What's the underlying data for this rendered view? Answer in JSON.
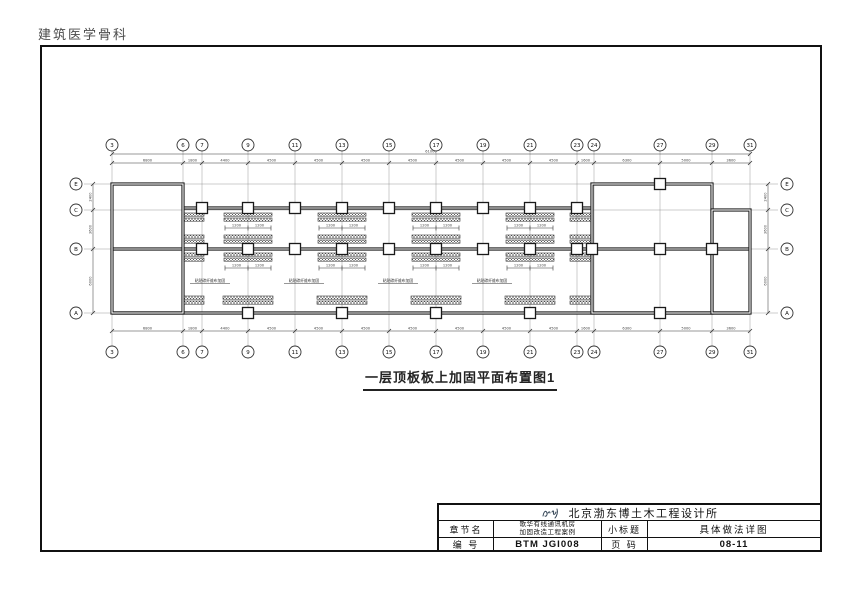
{
  "page": {
    "watermark": "建筑医学骨科"
  },
  "drawing": {
    "title": "一层顶板板上加固平面布置图1",
    "plan": {
      "cols": [
        {
          "label": "3",
          "x": 112
        },
        {
          "label": "6",
          "x": 183
        },
        {
          "label": "7",
          "x": 202
        },
        {
          "label": "9",
          "x": 248
        },
        {
          "label": "11",
          "x": 295
        },
        {
          "label": "13",
          "x": 342
        },
        {
          "label": "15",
          "x": 389
        },
        {
          "label": "17",
          "x": 436
        },
        {
          "label": "19",
          "x": 483
        },
        {
          "label": "21",
          "x": 530
        },
        {
          "label": "23",
          "x": 577
        },
        {
          "label": "24",
          "x": 594
        },
        {
          "label": "27",
          "x": 660
        },
        {
          "label": "29",
          "x": 712
        },
        {
          "label": "31",
          "x": 750
        }
      ],
      "rows": [
        {
          "label": "E",
          "y": 184
        },
        {
          "label": "C",
          "y": 210
        },
        {
          "label": "B",
          "y": 249
        },
        {
          "label": "A",
          "y": 313
        }
      ],
      "dims_x": [
        "6800",
        "1800",
        "4400",
        "4500",
        "4500",
        "4500",
        "4500",
        "4500",
        "4500",
        "4500",
        "1600",
        "6300",
        "5000",
        "3600"
      ],
      "dims_y": [
        "2400",
        "3600",
        "6000"
      ],
      "total_dim": "61000",
      "geom": {
        "top_bubble_y": 145,
        "bottom_bubble_y": 352,
        "left_bubble_x": 76,
        "right_bubble_x": 787,
        "bubble_r": 6,
        "dim_top_y": 163,
        "dim_total_y": 154,
        "dim_bottom_y": 331,
        "dim_left_x": 93,
        "dim_right_x": 768,
        "v_top": 150,
        "v_bot": 346,
        "h_left": 84,
        "h_right": 778
      },
      "rooms": [
        {
          "x": 112,
          "y": 184,
          "w": 71,
          "h": 129
        },
        {
          "x": 592,
          "y": 184,
          "w": 120,
          "h": 129
        },
        {
          "x": 712,
          "y": 210,
          "w": 38,
          "h": 103
        }
      ],
      "beams": [
        {
          "x1": 112,
          "y": 249,
          "x2": 750
        },
        {
          "x1": 112,
          "y": 313,
          "x2": 750
        },
        {
          "x1": 183,
          "y": 208,
          "x2": 592
        }
      ],
      "columns": [
        [
          202,
          208
        ],
        [
          248,
          208
        ],
        [
          295,
          208
        ],
        [
          342,
          208
        ],
        [
          389,
          208
        ],
        [
          436,
          208
        ],
        [
          483,
          208
        ],
        [
          530,
          208
        ],
        [
          577,
          208
        ],
        [
          202,
          249
        ],
        [
          248,
          249
        ],
        [
          295,
          249
        ],
        [
          342,
          249
        ],
        [
          389,
          249
        ],
        [
          436,
          249
        ],
        [
          483,
          249
        ],
        [
          530,
          249
        ],
        [
          577,
          249
        ],
        [
          592,
          249
        ],
        [
          660,
          249
        ],
        [
          712,
          249
        ],
        [
          248,
          313
        ],
        [
          342,
          313
        ],
        [
          436,
          313
        ],
        [
          530,
          313
        ],
        [
          660,
          313
        ],
        [
          660,
          184
        ]
      ],
      "column_size": 11,
      "strip_centers": [
        248,
        342,
        436,
        530
      ],
      "clusters": [
        {
          "dy": [
            213,
            218
          ],
          "half": 24
        },
        {
          "dy": [
            235,
            240
          ],
          "half": 24
        },
        {
          "dy": [
            253,
            258
          ],
          "half": 24
        },
        {
          "dy": [
            296,
            301
          ],
          "half": 25
        }
      ],
      "strip_h": 3.2,
      "edge_strips": [
        {
          "x": 182,
          "w": 22
        },
        {
          "x": 570,
          "w": 22
        }
      ],
      "strip_dim_rows": [
        228,
        268
      ],
      "strip_dim_label": "1200",
      "note": "粘贴碳纤维布加固",
      "note_y": 282,
      "colors": {
        "wall": "#1a1a1a",
        "grid": "#999",
        "dim": "#444",
        "hatch": "#555"
      }
    }
  },
  "titleblock": {
    "company": "北京渤东博土木工程设计所",
    "chapter_label": "章节名",
    "project_line1": "歌华有线通讯机房",
    "project_line2": "加固改造工程案例",
    "subtitle_label": "小标题",
    "subtitle_value": "具体做法详图",
    "number_label": "编  号",
    "number_value": "BTM JGI008",
    "page_label": "页  码",
    "page_value": "08-11"
  }
}
